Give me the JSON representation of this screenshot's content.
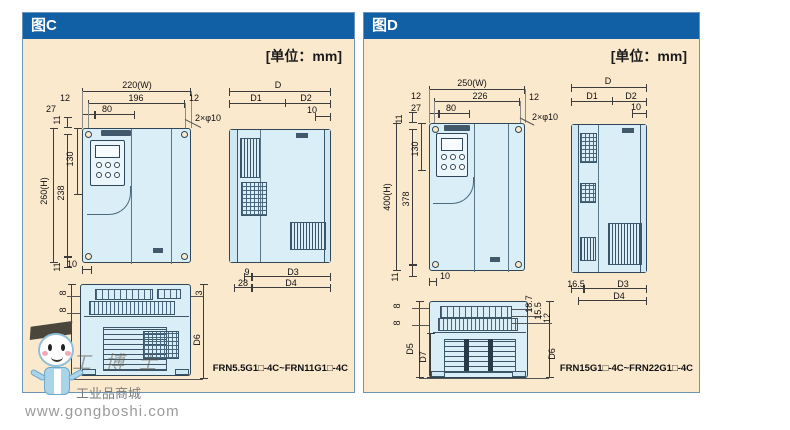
{
  "colors": {
    "header_blue": "#1160a6",
    "panel_bg": "#fbe9ce",
    "device_fill": "#d9eef7",
    "outline": "#2e4657"
  },
  "watermark": {
    "brand": "工业品商城",
    "url": "www.gongboshi.com",
    "faint": "工博士"
  },
  "panels": [
    {
      "title": "图C",
      "unit_label": "[单位：mm]",
      "model_range": "FRN5.5G1□-4C~FRN11G1□-4C",
      "dims": [
        {
          "t": "220(W)",
          "x": 114,
          "y": 72
        },
        {
          "t": "12",
          "x": 42,
          "y": 85
        },
        {
          "t": "196",
          "x": 113,
          "y": 85
        },
        {
          "t": "12",
          "x": 171,
          "y": 85
        },
        {
          "t": "27",
          "x": 28,
          "y": 96
        },
        {
          "t": "80",
          "x": 84,
          "y": 96
        },
        {
          "t": "11",
          "x": 34,
          "y": 107,
          "r": 1
        },
        {
          "t": "2×φ10",
          "x": 185,
          "y": 105
        },
        {
          "t": "130",
          "x": 47,
          "y": 146,
          "r": 1
        },
        {
          "t": "260(H)",
          "x": 21,
          "y": 178,
          "r": 1
        },
        {
          "t": "238",
          "x": 38,
          "y": 180,
          "r": 1
        },
        {
          "t": "11",
          "x": 34,
          "y": 254,
          "r": 1
        },
        {
          "t": "10",
          "x": 49,
          "y": 251
        },
        {
          "t": "D",
          "x": 255,
          "y": 72
        },
        {
          "t": "D1",
          "x": 233,
          "y": 85
        },
        {
          "t": "D2",
          "x": 283,
          "y": 85
        },
        {
          "t": "10",
          "x": 289,
          "y": 97
        },
        {
          "t": "9",
          "x": 224,
          "y": 259
        },
        {
          "t": "D3",
          "x": 270,
          "y": 259
        },
        {
          "t": "28",
          "x": 220,
          "y": 270
        },
        {
          "t": "D4",
          "x": 268,
          "y": 270
        },
        {
          "t": "8",
          "x": 40,
          "y": 280,
          "r": 1
        },
        {
          "t": "8",
          "x": 40,
          "y": 297,
          "r": 1
        },
        {
          "t": "D5",
          "x": 35,
          "y": 326,
          "r": 1
        },
        {
          "t": "⊗",
          "x": 44,
          "y": 334
        },
        {
          "t": "3",
          "x": 176,
          "y": 280,
          "r": 1
        },
        {
          "t": "D6",
          "x": 174,
          "y": 327,
          "r": 1
        }
      ]
    },
    {
      "title": "图D",
      "unit_label": "[单位：mm]",
      "model_range": "FRN15G1□-4C~FRN22G1□-4C",
      "dims": [
        {
          "t": "250(W)",
          "x": 108,
          "y": 70
        },
        {
          "t": "12",
          "x": 52,
          "y": 83
        },
        {
          "t": "226",
          "x": 116,
          "y": 83
        },
        {
          "t": "12",
          "x": 170,
          "y": 84
        },
        {
          "t": "27",
          "x": 52,
          "y": 95
        },
        {
          "t": "80",
          "x": 87,
          "y": 95
        },
        {
          "t": "11",
          "x": 35,
          "y": 106,
          "r": 1
        },
        {
          "t": "2×φ10",
          "x": 181,
          "y": 104
        },
        {
          "t": "130",
          "x": 51,
          "y": 136,
          "r": 1
        },
        {
          "t": "400(H)",
          "x": 23,
          "y": 184,
          "r": 1
        },
        {
          "t": "378",
          "x": 42,
          "y": 186,
          "r": 1
        },
        {
          "t": "11",
          "x": 31,
          "y": 264,
          "r": 1
        },
        {
          "t": "10",
          "x": 81,
          "y": 263
        },
        {
          "t": "D",
          "x": 244,
          "y": 68
        },
        {
          "t": "D1",
          "x": 228,
          "y": 83
        },
        {
          "t": "D2",
          "x": 267,
          "y": 83
        },
        {
          "t": "10",
          "x": 272,
          "y": 94
        },
        {
          "t": "16.5",
          "x": 212,
          "y": 271
        },
        {
          "t": "D3",
          "x": 259,
          "y": 271
        },
        {
          "t": "D4",
          "x": 255,
          "y": 283
        },
        {
          "t": "8",
          "x": 33,
          "y": 293,
          "r": 1
        },
        {
          "t": "8",
          "x": 33,
          "y": 310,
          "r": 1
        },
        {
          "t": "D5",
          "x": 46,
          "y": 336,
          "r": 1
        },
        {
          "t": "D7",
          "x": 59,
          "y": 344,
          "r": 1
        },
        {
          "t": "18.7",
          "x": 165,
          "y": 291,
          "r": 1
        },
        {
          "t": "15.5",
          "x": 174,
          "y": 298,
          "r": 1
        },
        {
          "t": "12",
          "x": 183,
          "y": 305,
          "r": 1
        },
        {
          "t": "D6",
          "x": 188,
          "y": 341,
          "r": 1
        }
      ]
    }
  ]
}
